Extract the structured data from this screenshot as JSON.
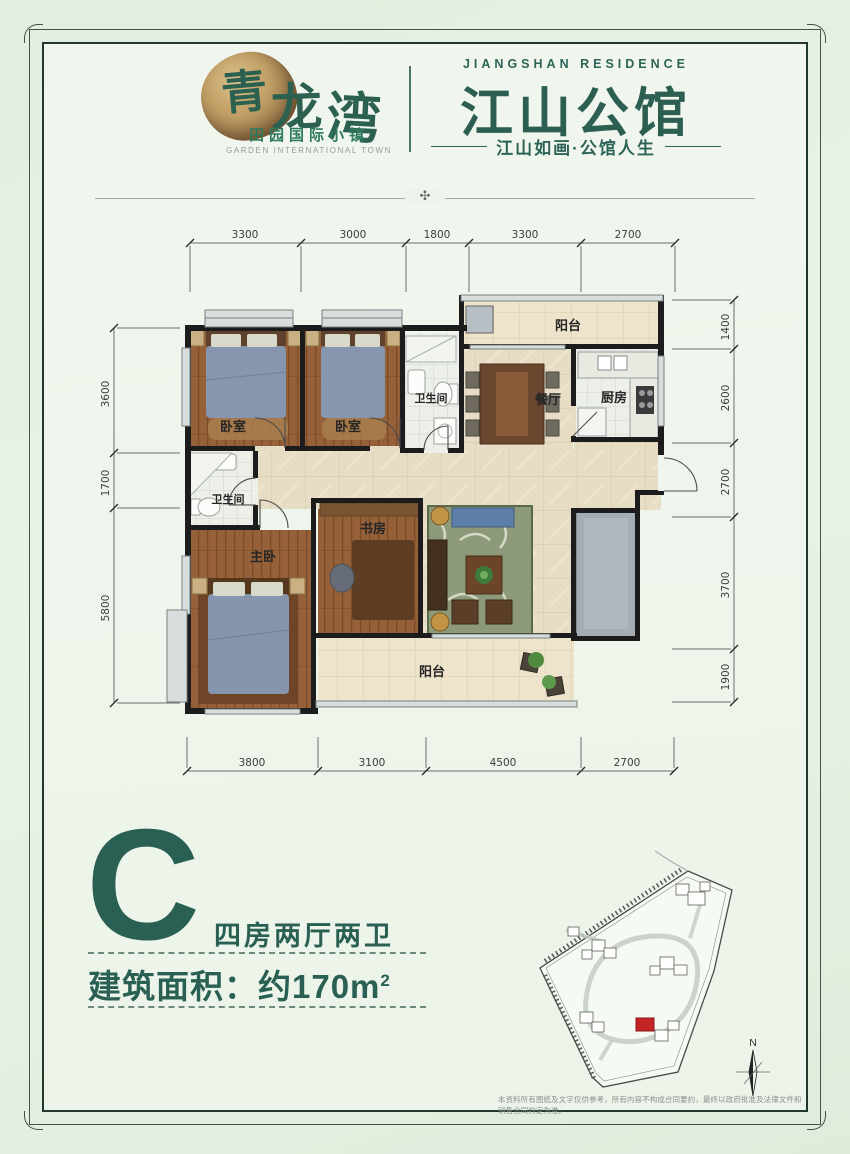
{
  "header": {
    "brand": {
      "name_chars": [
        "青",
        "龙",
        "湾"
      ],
      "sub": "田园国际小镇",
      "sub_en": "GARDEN INTERNATIONAL TOWN"
    },
    "project": {
      "en": "JIANGSHAN RESIDENCE",
      "name": "江山公馆",
      "slogan": "江山如画·公馆人生"
    },
    "ornament": "✣"
  },
  "floorplan": {
    "rooms": {
      "bed1": "卧室",
      "bed2": "卧室",
      "bath1": "卫生间",
      "balcony_top": "阳台",
      "dining": "餐厅",
      "kitchen": "厨房",
      "bath2": "卫生间",
      "master": "主卧",
      "study": "书房",
      "balcony_bottom": "阳台"
    },
    "dims": {
      "top": [
        "3300",
        "3000",
        "1800",
        "3300",
        "2700"
      ],
      "bottom": [
        "3800",
        "3100",
        "4500",
        "2700"
      ],
      "left": [
        "3600",
        "1700",
        "5800"
      ],
      "right": [
        "1400",
        "2600",
        "2700",
        "3700",
        "1900"
      ]
    }
  },
  "unit": {
    "letter": "C",
    "type": "四房两厅两卫",
    "area_prefix": "建筑面积：约",
    "area_value": "170m",
    "area_sup": "2"
  },
  "siteplan": {
    "compass_label": "N"
  },
  "disclaimer": "本资料所有图纸及文字仅供参考，所有内容不构成合同要约，最终以政府批准及法律文件和销售合同约定为准。"
}
